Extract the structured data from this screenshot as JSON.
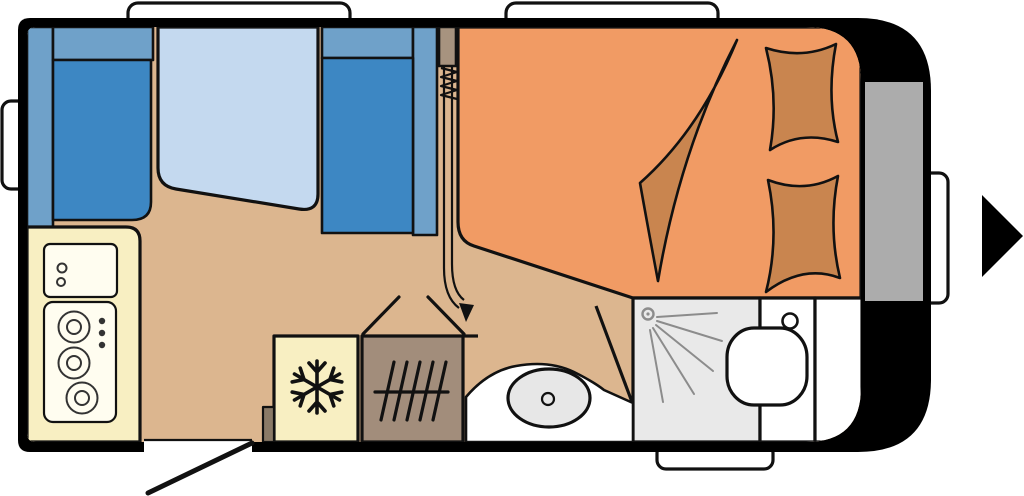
{
  "colors": {
    "background": "#ffffff",
    "body": "#000000",
    "outline": "#111111",
    "floor": "#dcb68f",
    "seat": "#3d87c3",
    "backrest": "#6fa1c9",
    "table": "#c4d9ef",
    "bed": "#f19b64",
    "bedding": "#c9854f",
    "kitchen": "#f8efc2",
    "panel": "#fffdf0",
    "heater": "#a28d7b",
    "partition": "#a7937f",
    "locker": "#acacac",
    "shower": "#e9e9e9",
    "basin": "#e7e7e7",
    "white": "#ffffff",
    "step": "#8a7a67",
    "spray": "#8c8c8c",
    "burner": "#333333"
  },
  "icons": [
    "snowflake-icon",
    "shower-head-icon",
    "heater-grille-icon",
    "exit-arrow-icon",
    "curtain-path-arrow-icon",
    "door-swing-icon"
  ],
  "elements": {
    "windows": [
      "roof-window-front",
      "roof-window-rear",
      "side-window-left",
      "rear-handle",
      "bathroom-window"
    ],
    "furniture": [
      "front-dinette-seat",
      "rear-dinette-seat",
      "dinette-table",
      "kitchen-counter",
      "sink-unit",
      "stove",
      "fridge",
      "heater",
      "entry-step",
      "entry-door",
      "double-bed",
      "blanket",
      "pillow-left",
      "pillow-right",
      "exterior-locker",
      "shower-cubicle",
      "toilet",
      "washbasin",
      "bathroom-cabinet"
    ]
  }
}
